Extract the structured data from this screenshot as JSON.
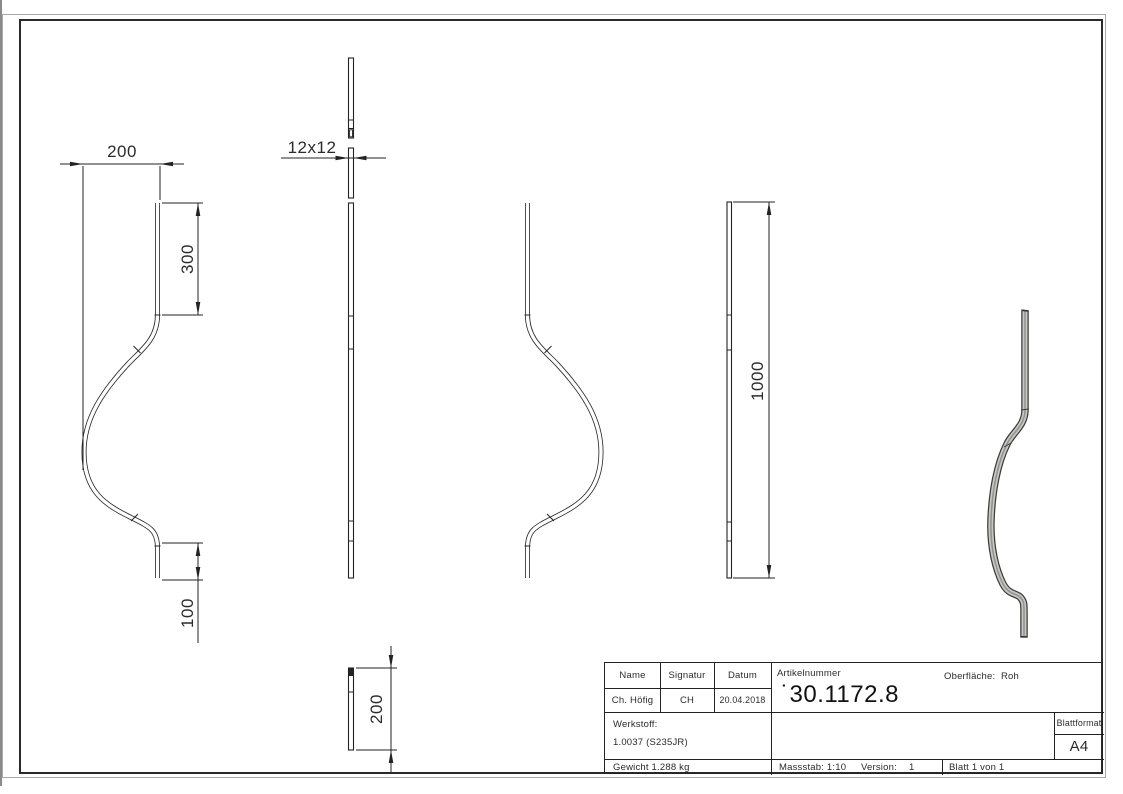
{
  "drawing": {
    "dimensions": {
      "width_offset": "200",
      "top_leg": "300",
      "bottom_leg": "100",
      "cross_section": "12x12",
      "total_height": "1000",
      "depth": "200"
    },
    "title_block": {
      "name_label": "Name",
      "signatur_label": "Signatur",
      "datum_label": "Datum",
      "name_value": "Ch. Höfig",
      "signatur_value": "CH",
      "datum_value": "20.04.2018",
      "artikelnummer_label": "Artikelnummer",
      "artikelnummer_value": "˙30.1172.8",
      "oberflaeche_label": "Oberfläche:",
      "oberflaeche_value": "Roh",
      "werkstoff_label": "Werkstoff:",
      "werkstoff_value": "1.0037 (S235JR)",
      "gewicht": "Gewicht 1.288 kg",
      "massstab": "Massstab: 1:10",
      "version_label": "Version:",
      "version_value": "1",
      "blatt": "Blatt 1 von 1",
      "blattformat_label": "Blattformat",
      "blattformat_value": "A4"
    },
    "colors": {
      "line": "#232323",
      "bar3d_dark": "#3c3c3a",
      "bar3d_light": "#c7c7c4"
    }
  }
}
